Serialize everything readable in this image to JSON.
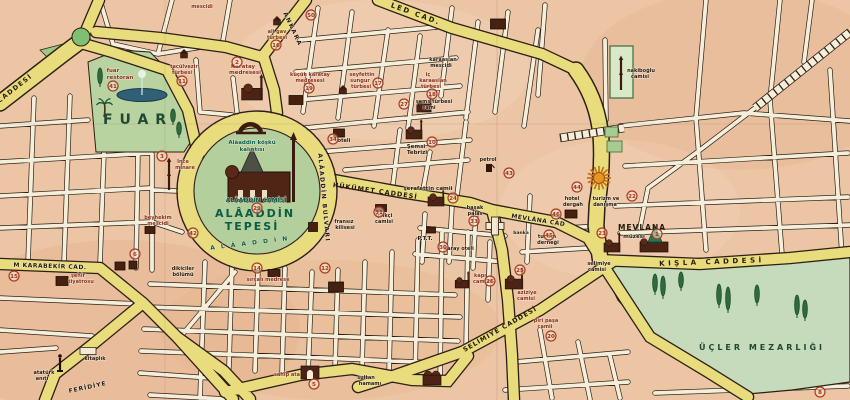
{
  "palette": {
    "paper": "#ecc5a4",
    "paper_dark": "#dfa87f",
    "paper_light": "#f4d8bd",
    "street": "#f5eedb",
    "road_yellow": "#e9dc7d",
    "outline": "#2c2014",
    "park_green": "#b8d3a0",
    "hill_green": "#b2cf9c",
    "cemetery_green": "#c5dbbc",
    "roundabout_green": "#7fbf72",
    "pool_blue": "#2f6075",
    "marker_red": "#a93a24",
    "marker_fill": "#f6e7cd",
    "k": "#271a0e",
    "r": "#8a2f1d",
    "g": "#1d4a31",
    "t": "#0a5c49",
    "building": "#4c2415",
    "tree_green": "#2e6b3b",
    "sun_orange": "#e8961e"
  },
  "map": {
    "labels": [
      {
        "t": "CADDESİ",
        "x": 16,
        "y": 90,
        "s": 6.5,
        "c": "k",
        "r": -38,
        "ls": 1.5
      },
      {
        "t": "ANKARA",
        "x": 291,
        "y": 30,
        "s": 6,
        "c": "k",
        "r": 65,
        "ls": 1.5
      },
      {
        "t": "LED CAD.",
        "x": 415,
        "y": 16,
        "s": 7,
        "c": "k",
        "r": 20,
        "ls": 2
      },
      {
        "t": "HÜKÜMET CADDESİ",
        "x": 375,
        "y": 193,
        "s": 6.5,
        "c": "k",
        "r": 8,
        "ls": 1
      },
      {
        "t": "MEVLÂNA CAD",
        "x": 538,
        "y": 222,
        "s": 6,
        "c": "k",
        "r": 9,
        "ls": 0.5
      },
      {
        "t": "KIŞLA CADDESİ",
        "x": 712,
        "y": 264,
        "s": 7,
        "c": "k",
        "r": -2,
        "ls": 3.5
      },
      {
        "t": "SELİMİYE CADDESİ",
        "x": 501,
        "y": 331,
        "s": 6.5,
        "c": "k",
        "r": -30,
        "ls": 1
      },
      {
        "t": "M KARABEKİR CAD.",
        "x": 50,
        "y": 268,
        "s": 6,
        "c": "k",
        "r": 2,
        "ls": 0.5
      },
      {
        "t": "FERİDİYE",
        "x": 88,
        "y": 389,
        "s": 6,
        "c": "k",
        "r": -12,
        "ls": 1
      },
      {
        "t": "ALÂADDİN BULVARI",
        "x": 322,
        "y": 198,
        "s": 6,
        "c": "k",
        "r": 85,
        "ls": 1.5
      },
      {
        "t": "A L Â A D D İ N",
        "x": 250,
        "y": 245,
        "s": 6,
        "c": "t",
        "r": -7,
        "ls": 2
      },
      {
        "t": "FUAR",
        "x": 138,
        "y": 124,
        "s": 14,
        "c": "g",
        "ls": 7
      },
      {
        "t": "ALÂADDİN",
        "x": 255,
        "y": 217,
        "s": 11,
        "c": "t",
        "ls": 2
      },
      {
        "t": "TEPESİ",
        "x": 252,
        "y": 230,
        "s": 11,
        "c": "t",
        "ls": 2
      },
      {
        "t": "ÜÇLER MEZARLIĞI",
        "x": 762,
        "y": 350,
        "s": 8,
        "c": "g",
        "ls": 3
      },
      {
        "t": "Alâaddin köşkü",
        "x": 252,
        "y": 144,
        "s": 5.5,
        "c": "t"
      },
      {
        "t": "kalıntısı",
        "x": 252,
        "y": 151,
        "s": 5.5,
        "c": "t"
      },
      {
        "t": "ALÂADDİN CAMİSİ",
        "x": 256,
        "y": 202,
        "s": 6,
        "c": "t"
      },
      {
        "t": "MEVLANA",
        "x": 642,
        "y": 230,
        "s": 7.5,
        "c": "k",
        "ls": 1
      },
      {
        "t": "müzesi",
        "x": 634,
        "y": 238,
        "s": 5.5,
        "c": "k"
      },
      {
        "t": "mescidi",
        "x": 202,
        "y": 8,
        "s": 5,
        "c": "r"
      },
      {
        "t": "fuar",
        "x": 113,
        "y": 72,
        "s": 5.5,
        "c": "r"
      },
      {
        "t": "restoran",
        "x": 120,
        "y": 79,
        "s": 5.5,
        "c": "r"
      },
      {
        "t": "tacülvezir",
        "x": 184,
        "y": 68,
        "s": 5,
        "c": "r"
      },
      {
        "t": "türbesi",
        "x": 182,
        "y": 74,
        "s": 5,
        "c": "r"
      },
      {
        "t": "Karatay",
        "x": 243,
        "y": 68,
        "s": 5.5,
        "c": "r"
      },
      {
        "t": "medresesi",
        "x": 245,
        "y": 74,
        "s": 5.5,
        "c": "r"
      },
      {
        "t": "ali gav",
        "x": 277,
        "y": 33,
        "s": 5,
        "c": "r"
      },
      {
        "t": "türbesi",
        "x": 277,
        "y": 39,
        "s": 5,
        "c": "r"
      },
      {
        "t": "küçük karatay",
        "x": 310,
        "y": 76,
        "s": 5,
        "c": "r"
      },
      {
        "t": "medresesi",
        "x": 310,
        "y": 82,
        "s": 5,
        "c": "r"
      },
      {
        "t": "seyfettin",
        "x": 362,
        "y": 76,
        "s": 5,
        "c": "r"
      },
      {
        "t": "sungur",
        "x": 360,
        "y": 82,
        "s": 5,
        "c": "r"
      },
      {
        "t": "türbesi",
        "x": 361,
        "y": 88,
        "s": 5,
        "c": "r"
      },
      {
        "t": "karaaslan",
        "x": 443,
        "y": 61,
        "s": 5,
        "c": "k"
      },
      {
        "t": "mescidi",
        "x": 441,
        "y": 67,
        "s": 5,
        "c": "k"
      },
      {
        "t": "iç",
        "x": 428,
        "y": 76,
        "s": 5,
        "c": "r"
      },
      {
        "t": "karaaslan",
        "x": 433,
        "y": 82,
        "s": 5,
        "c": "r"
      },
      {
        "t": "türbesi",
        "x": 431,
        "y": 88,
        "s": 5,
        "c": "r"
      },
      {
        "t": "şems türbesi",
        "x": 434,
        "y": 103,
        "s": 5,
        "c": "k"
      },
      {
        "t": "cami",
        "x": 429,
        "y": 109,
        "s": 5,
        "c": "k"
      },
      {
        "t": "Şemsi",
        "x": 416,
        "y": 148,
        "s": 5.5,
        "c": "k"
      },
      {
        "t": "Tebrizi",
        "x": 417,
        "y": 154,
        "s": 5.5,
        "c": "k"
      },
      {
        "t": "petrol",
        "x": 488,
        "y": 161,
        "s": 5,
        "c": "k"
      },
      {
        "t": "şerafettin camii",
        "x": 428,
        "y": 190,
        "s": 5.5,
        "c": "k"
      },
      {
        "t": "iplikçi",
        "x": 384,
        "y": 217,
        "s": 5,
        "c": "k"
      },
      {
        "t": "camisi",
        "x": 384,
        "y": 223,
        "s": 5,
        "c": "k"
      },
      {
        "t": "fransız",
        "x": 344,
        "y": 223,
        "s": 5,
        "c": "k"
      },
      {
        "t": "kilisesi",
        "x": 345,
        "y": 229,
        "s": 5,
        "c": "k"
      },
      {
        "t": "P.T.T.",
        "x": 425,
        "y": 240,
        "s": 5.5,
        "c": "k"
      },
      {
        "t": "saray oteli",
        "x": 459,
        "y": 250,
        "s": 5,
        "c": "k"
      },
      {
        "t": "başak",
        "x": 475,
        "y": 209,
        "s": 5,
        "c": "k"
      },
      {
        "t": "palas",
        "x": 475,
        "y": 215,
        "s": 5,
        "c": "k"
      },
      {
        "t": "hotel",
        "x": 572,
        "y": 200,
        "s": 5,
        "c": "k"
      },
      {
        "t": "dergah",
        "x": 573,
        "y": 206,
        "s": 5,
        "c": "k"
      },
      {
        "t": "turizm ve",
        "x": 606,
        "y": 200,
        "s": 5,
        "c": "k"
      },
      {
        "t": "danışma",
        "x": 605,
        "y": 206,
        "s": 5,
        "c": "k"
      },
      {
        "t": "banka",
        "x": 521,
        "y": 234,
        "s": 4.5,
        "c": "k"
      },
      {
        "t": "turizm",
        "x": 547,
        "y": 238,
        "s": 5,
        "c": "k"
      },
      {
        "t": "derneği",
        "x": 548,
        "y": 244,
        "s": 5,
        "c": "k"
      },
      {
        "t": "aziziye",
        "x": 527,
        "y": 294,
        "s": 5,
        "c": "r"
      },
      {
        "t": "camisi",
        "x": 526,
        "y": 300,
        "s": 5,
        "c": "r"
      },
      {
        "t": "kapı",
        "x": 480,
        "y": 277,
        "s": 5,
        "c": "r"
      },
      {
        "t": "camisi",
        "x": 482,
        "y": 283,
        "s": 5,
        "c": "r"
      },
      {
        "t": "piri paşa",
        "x": 546,
        "y": 322,
        "s": 5,
        "c": "r"
      },
      {
        "t": "camii",
        "x": 545,
        "y": 328,
        "s": 5,
        "c": "r"
      },
      {
        "t": "selimiye",
        "x": 599,
        "y": 265,
        "s": 5,
        "c": "k"
      },
      {
        "t": "camisi",
        "x": 597,
        "y": 271,
        "s": 5,
        "c": "k"
      },
      {
        "t": "nakiboğlu",
        "x": 641,
        "y": 72,
        "s": 5,
        "c": "k"
      },
      {
        "t": "camisi",
        "x": 640,
        "y": 78,
        "s": 5,
        "c": "k"
      },
      {
        "t": "İnce",
        "x": 183,
        "y": 163,
        "s": 5,
        "c": "r"
      },
      {
        "t": "minare",
        "x": 185,
        "y": 169,
        "s": 5,
        "c": "r"
      },
      {
        "t": "beyhekim",
        "x": 158,
        "y": 219,
        "s": 5,
        "c": "r"
      },
      {
        "t": "mescidi",
        "x": 158,
        "y": 225,
        "s": 5,
        "c": "r"
      },
      {
        "t": "şehir",
        "x": 78,
        "y": 277,
        "s": 5,
        "c": "r"
      },
      {
        "t": "tiyatrosu",
        "x": 81,
        "y": 283,
        "s": 5,
        "c": "r"
      },
      {
        "t": "dikiciler",
        "x": 183,
        "y": 270,
        "s": 5,
        "c": "k"
      },
      {
        "t": "bölümü",
        "x": 183,
        "y": 276,
        "s": 5,
        "c": "k"
      },
      {
        "t": "kitaplık",
        "x": 95,
        "y": 360,
        "s": 5,
        "c": "k"
      },
      {
        "t": "atatürk",
        "x": 44,
        "y": 374,
        "s": 5,
        "c": "k"
      },
      {
        "t": "anıtı",
        "x": 42,
        "y": 380,
        "s": 5,
        "c": "k"
      },
      {
        "t": "sahip ata",
        "x": 287,
        "y": 376,
        "s": 5,
        "c": "r"
      },
      {
        "t": "sultan",
        "x": 366,
        "y": 379,
        "s": 5,
        "c": "k"
      },
      {
        "t": "hamamı",
        "x": 370,
        "y": 385,
        "s": 5,
        "c": "k"
      },
      {
        "t": "sırçalı medrese",
        "x": 268,
        "y": 281,
        "s": 5,
        "c": "r"
      },
      {
        "t": "oteli",
        "x": 344,
        "y": 142,
        "s": 5,
        "c": "k"
      }
    ],
    "markers": [
      {
        "n": "1",
        "x": 657,
        "y": 234
      },
      {
        "n": "2",
        "x": 237,
        "y": 62
      },
      {
        "n": "3",
        "x": 162,
        "y": 156
      },
      {
        "n": "5",
        "x": 314,
        "y": 384
      },
      {
        "n": "6",
        "x": 135,
        "y": 254
      },
      {
        "n": "8",
        "x": 820,
        "y": 392
      },
      {
        "n": "10",
        "x": 432,
        "y": 142
      },
      {
        "n": "11",
        "x": 182,
        "y": 81
      },
      {
        "n": "12",
        "x": 325,
        "y": 268
      },
      {
        "n": "14",
        "x": 257,
        "y": 268
      },
      {
        "n": "15",
        "x": 14,
        "y": 276
      },
      {
        "n": "16",
        "x": 276,
        "y": 45
      },
      {
        "n": "17",
        "x": 378,
        "y": 83
      },
      {
        "n": "18",
        "x": 432,
        "y": 94
      },
      {
        "n": "19",
        "x": 309,
        "y": 88
      },
      {
        "n": "20",
        "x": 551,
        "y": 336
      },
      {
        "n": "22",
        "x": 632,
        "y": 196
      },
      {
        "n": "23",
        "x": 602,
        "y": 233
      },
      {
        "n": "24",
        "x": 453,
        "y": 198
      },
      {
        "n": "25",
        "x": 520,
        "y": 270
      },
      {
        "n": "26",
        "x": 490,
        "y": 281
      },
      {
        "n": "27",
        "x": 404,
        "y": 104
      },
      {
        "n": "29",
        "x": 257,
        "y": 208
      },
      {
        "n": "30",
        "x": 443,
        "y": 247
      },
      {
        "n": "31",
        "x": 379,
        "y": 212
      },
      {
        "n": "33",
        "x": 474,
        "y": 221
      },
      {
        "n": "34",
        "x": 333,
        "y": 139
      },
      {
        "n": "41",
        "x": 113,
        "y": 86
      },
      {
        "n": "42",
        "x": 193,
        "y": 233
      },
      {
        "n": "43",
        "x": 509,
        "y": 173
      },
      {
        "n": "44",
        "x": 577,
        "y": 187
      },
      {
        "n": "45",
        "x": 549,
        "y": 235
      },
      {
        "n": "46",
        "x": 556,
        "y": 214
      },
      {
        "n": "50",
        "x": 311,
        "y": 15
      }
    ],
    "icons": [
      {
        "t": "pool",
        "x": 142,
        "y": 95
      },
      {
        "t": "palm",
        "x": 104,
        "y": 117
      },
      {
        "t": "cypress",
        "x": 100,
        "y": 84,
        "h": 16
      },
      {
        "t": "cypress",
        "x": 173,
        "y": 122,
        "h": 13
      },
      {
        "t": "cypress",
        "x": 179,
        "y": 135,
        "h": 13
      },
      {
        "t": "turbe",
        "x": 184,
        "y": 58
      },
      {
        "t": "mosque",
        "x": 252,
        "y": 100,
        "s": 1.3
      },
      {
        "t": "turbe",
        "x": 277,
        "y": 25
      },
      {
        "t": "block",
        "x": 296,
        "y": 100,
        "w": 14,
        "h": 9
      },
      {
        "t": "turbe",
        "x": 343,
        "y": 94
      },
      {
        "t": "block",
        "x": 339,
        "y": 133,
        "w": 11,
        "h": 8
      },
      {
        "t": "block",
        "x": 498,
        "y": 24,
        "w": 15,
        "h": 10
      },
      {
        "t": "mosque",
        "x": 424,
        "y": 112,
        "s": 0.9
      },
      {
        "t": "mosque",
        "x": 414,
        "y": 139,
        "s": 1.0
      },
      {
        "t": "arch",
        "x": 250,
        "y": 130
      },
      {
        "t": "bigmosque",
        "x": 256,
        "y": 188
      },
      {
        "t": "minaret",
        "x": 169,
        "y": 190,
        "h": 28
      },
      {
        "t": "block",
        "x": 150,
        "y": 230,
        "w": 10,
        "h": 7
      },
      {
        "t": "cross",
        "x": 495,
        "y": 226
      },
      {
        "t": "block",
        "x": 313,
        "y": 227,
        "w": 9,
        "h": 9
      },
      {
        "t": "block",
        "x": 381,
        "y": 208,
        "w": 11,
        "h": 7
      },
      {
        "t": "mosque",
        "x": 436,
        "y": 206,
        "s": 1.0
      },
      {
        "t": "pump",
        "x": 489,
        "y": 172
      },
      {
        "t": "block",
        "x": 431,
        "y": 230,
        "w": 9,
        "h": 6
      },
      {
        "t": "mosque",
        "x": 514,
        "y": 289,
        "s": 1.1
      },
      {
        "t": "mosque",
        "x": 462,
        "y": 288,
        "s": 0.85
      },
      {
        "t": "sun",
        "x": 599,
        "y": 178
      },
      {
        "t": "block",
        "x": 571,
        "y": 214,
        "w": 12,
        "h": 8
      },
      {
        "t": "mevlana",
        "x": 654,
        "y": 252
      },
      {
        "t": "mosque",
        "x": 612,
        "y": 252,
        "s": 1.0
      },
      {
        "t": "minaret",
        "x": 621,
        "y": 90,
        "h": 30
      },
      {
        "t": "gate",
        "x": 310,
        "y": 374
      },
      {
        "t": "hamam",
        "x": 432,
        "y": 380
      },
      {
        "t": "block",
        "x": 120,
        "y": 266,
        "w": 10,
        "h": 8
      },
      {
        "t": "block",
        "x": 133,
        "y": 265,
        "w": 8,
        "h": 8
      },
      {
        "t": "statue",
        "x": 60,
        "y": 366
      },
      {
        "t": "block",
        "x": 88,
        "y": 351,
        "w": 16,
        "h": 7,
        "light": true
      },
      {
        "t": "block",
        "x": 62,
        "y": 281,
        "w": 12,
        "h": 9
      },
      {
        "t": "block",
        "x": 274,
        "y": 273,
        "w": 12,
        "h": 7
      },
      {
        "t": "block",
        "x": 336,
        "y": 287,
        "w": 15,
        "h": 10
      }
    ],
    "trees": [
      {
        "x": 655,
        "y": 292,
        "h": 18
      },
      {
        "x": 663,
        "y": 296,
        "h": 20
      },
      {
        "x": 681,
        "y": 288,
        "h": 16
      },
      {
        "x": 719,
        "y": 305,
        "h": 21
      },
      {
        "x": 728,
        "y": 310,
        "h": 23
      },
      {
        "x": 757,
        "y": 303,
        "h": 18
      },
      {
        "x": 797,
        "y": 315,
        "h": 20
      },
      {
        "x": 805,
        "y": 318,
        "h": 18
      }
    ]
  }
}
